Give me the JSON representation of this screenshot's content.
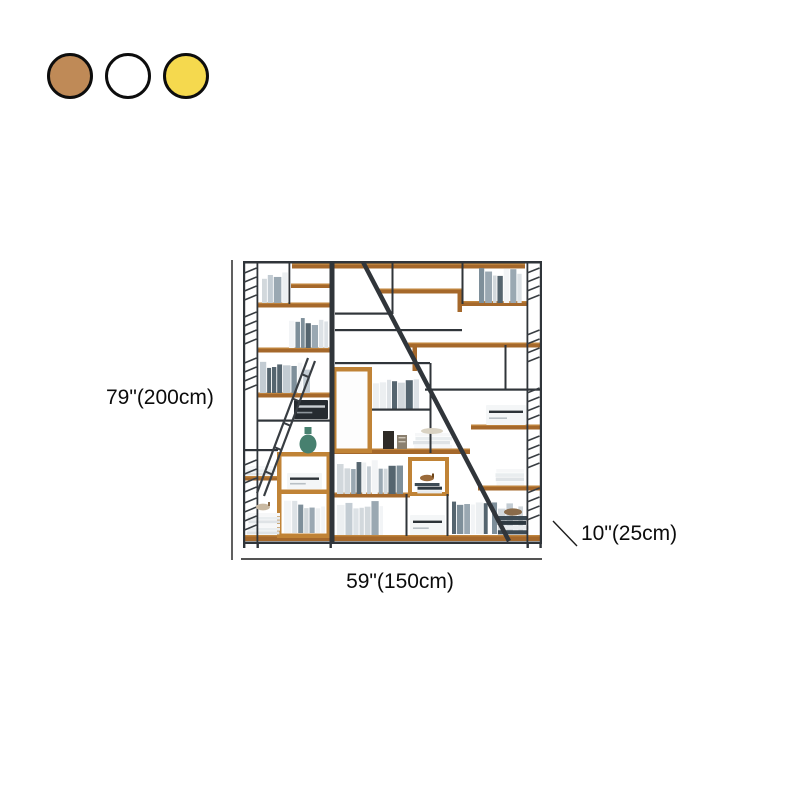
{
  "swatches": {
    "border_color": "#0d0d0d",
    "items": [
      {
        "name": "brown",
        "hex": "#bf8a57"
      },
      {
        "name": "white",
        "hex": "#ffffff"
      },
      {
        "name": "yellow",
        "hex": "#f5d94e"
      }
    ]
  },
  "product_image": {
    "description": "Industrial style bookshelf with black metal frame, wood shelves, books and decor items",
    "dimensions": {
      "height": "79\"(200cm)",
      "width": "59\"(150cm)",
      "depth": "10\"(25cm)"
    }
  },
  "palette": {
    "frame": "#30353a",
    "wood": "#a5682b",
    "wood-hi": "#c0853e",
    "wood-frame": "#c08336",
    "wood-dark": "#8a561f",
    "dim-line": "#1c1c1c",
    "text": "#0c0c0c",
    "teal": "#47806f",
    "swatch-border": "#0d0d0d"
  }
}
